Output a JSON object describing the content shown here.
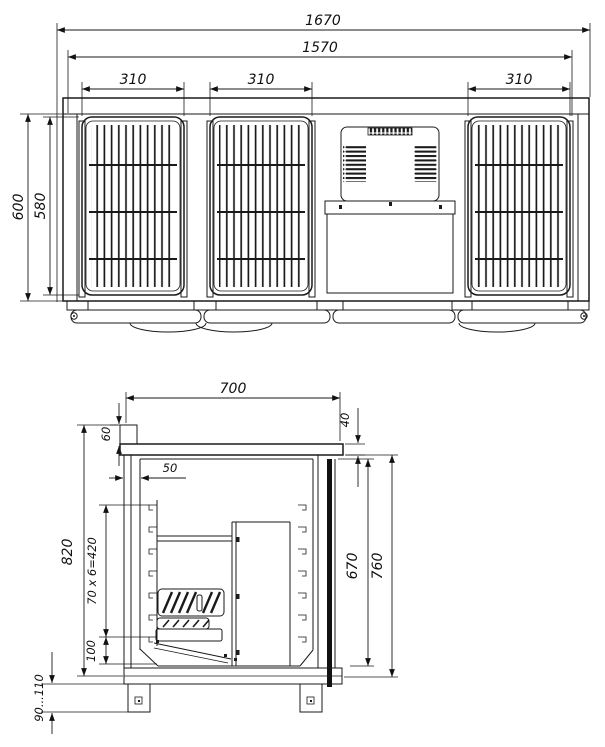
{
  "front_view": {
    "overall_width": "1670",
    "doors_span_width": "1570",
    "door_widths": [
      "310",
      "310",
      "310"
    ],
    "overall_height": "600",
    "door_height": "580"
  },
  "side_view": {
    "depth": "700",
    "splashback_height": "60",
    "worktop_offset": "40",
    "wall_thickness": "50",
    "body_height": "820",
    "shelf_pitch": "70 x 6=420",
    "bottom_clearance": "100",
    "inner_height": "670",
    "front_height": "760",
    "leg_height": "90...110"
  }
}
